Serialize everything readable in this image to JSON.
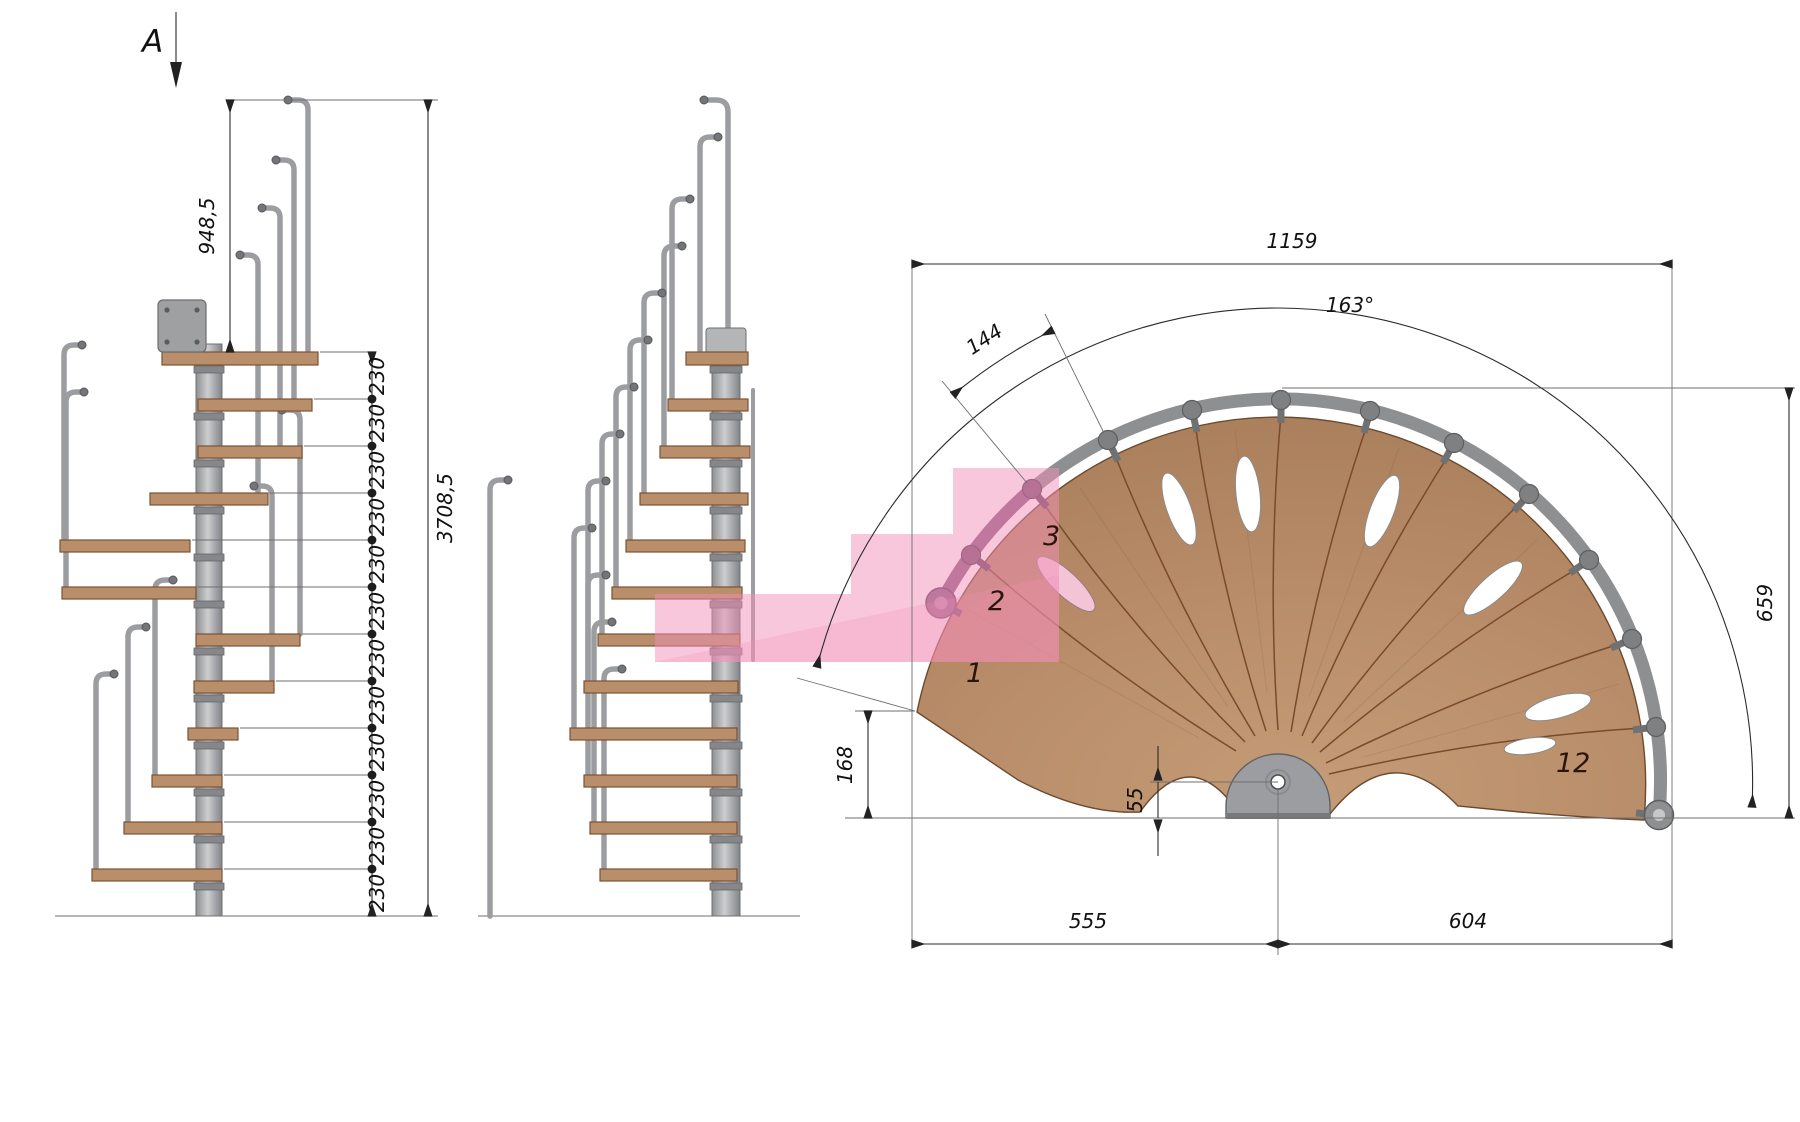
{
  "meta": {
    "type": "technical-drawing",
    "subject": "modular spiral staircase - two elevations and fan plan view"
  },
  "dims": {
    "section_label": "A",
    "top_rail_height": "948,5",
    "riser": "230",
    "total_height": "3708,5",
    "plan_width": "1159",
    "plan_angle": "163°",
    "tread_outer_width": "144",
    "plan_height": "659",
    "first_tread_corner": "168",
    "pole_offset": "55",
    "left_span": "555",
    "right_span": "604"
  },
  "treads": {
    "n1": "1",
    "n2": "2",
    "n3": "3",
    "n12": "12"
  },
  "counts": {
    "riser_segments": 12,
    "plan_treads": 12
  },
  "colors": {
    "wood": "#b98e6b",
    "steel": "#9b9da0",
    "pink_overlay": "#f48fb8",
    "purple_rail": "#8b5f83",
    "dim_line": "#2b2b2b"
  }
}
